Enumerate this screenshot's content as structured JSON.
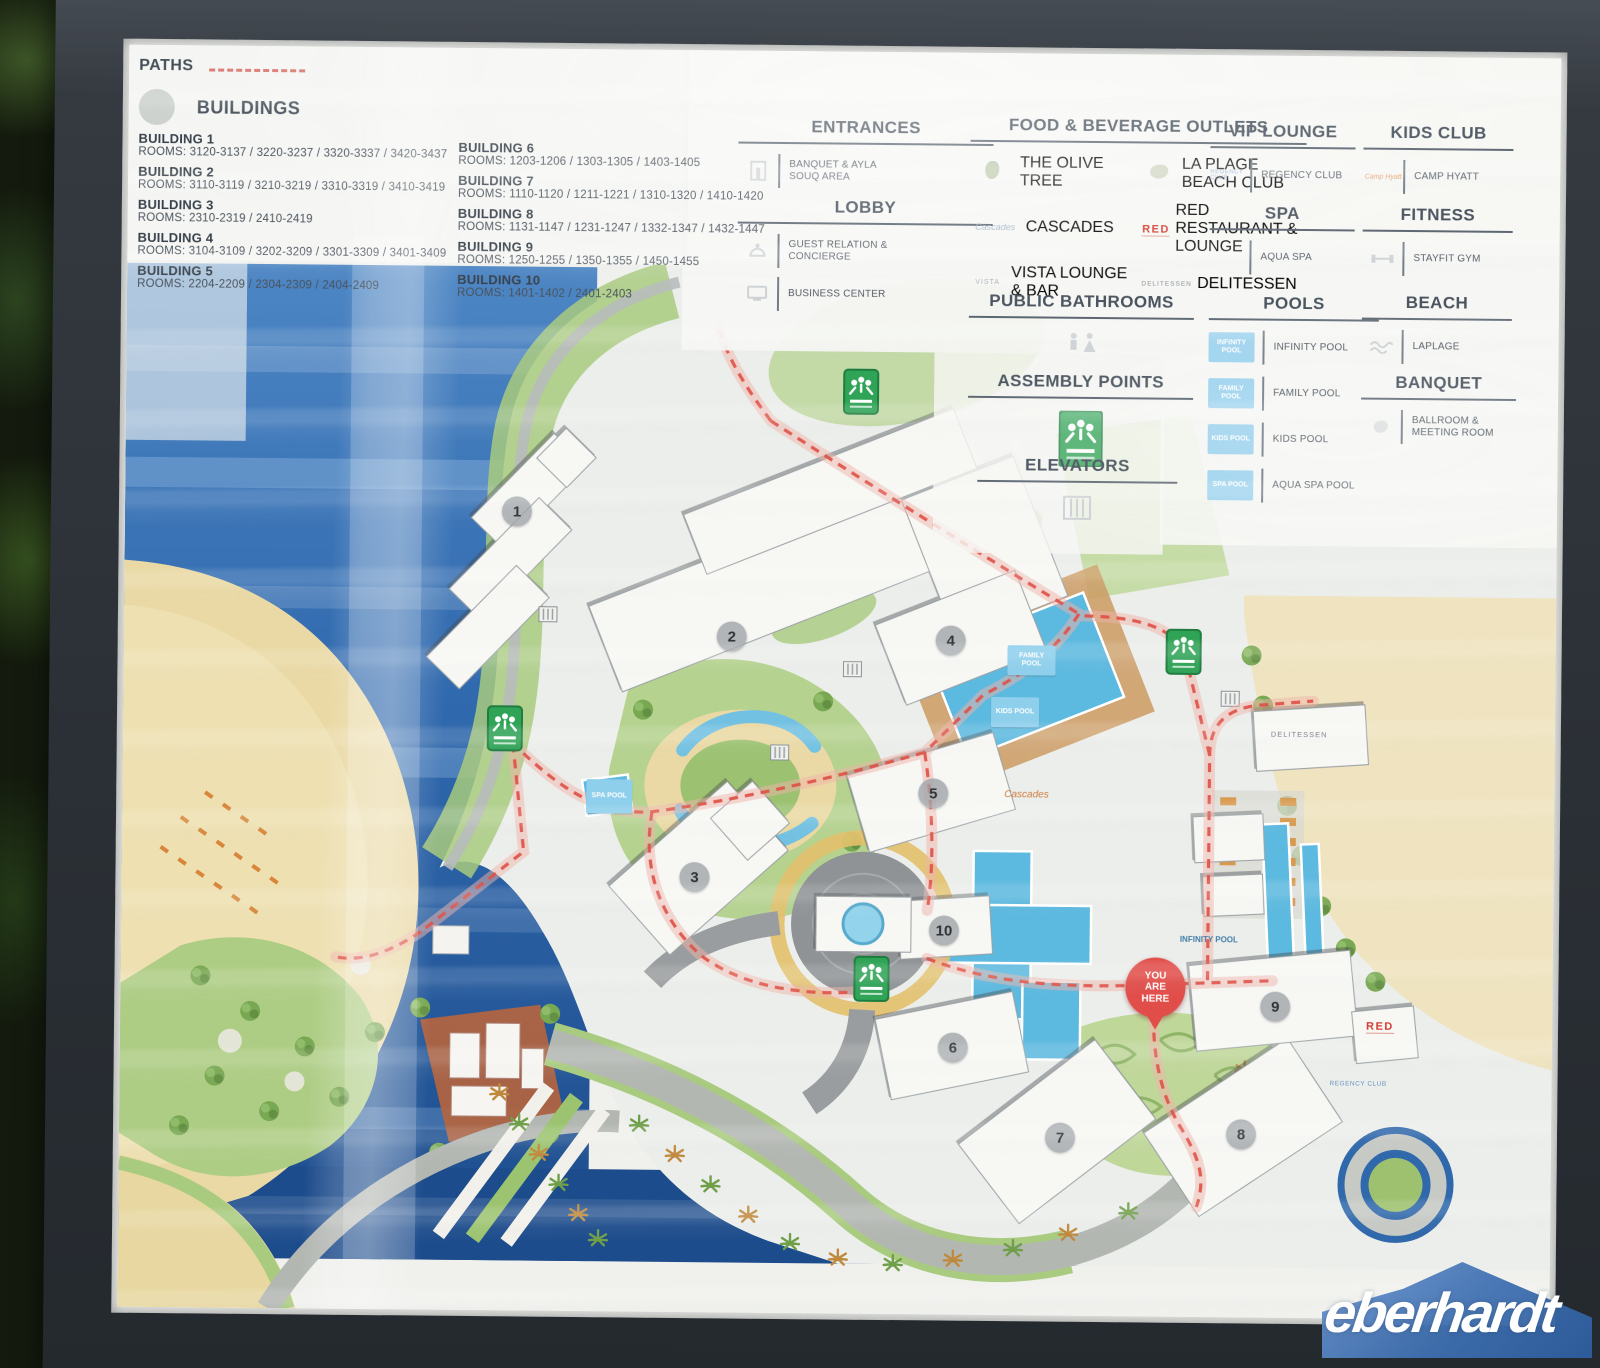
{
  "legend": {
    "paths_label": "PATHS",
    "buildings_label": "BUILDINGS",
    "buildings": [
      {
        "name": "BUILDING 1",
        "rooms": "ROOMS: 3120-3137 / 3220-3237 / 3320-3337 / 3420-3437"
      },
      {
        "name": "BUILDING 2",
        "rooms": "ROOMS: 3110-3119 / 3210-3219 / 3310-3319 / 3410-3419"
      },
      {
        "name": "BUILDING 3",
        "rooms": "ROOMS: 2310-2319 / 2410-2419"
      },
      {
        "name": "BUILDING 4",
        "rooms": "ROOMS: 3104-3109 / 3202-3209 / 3301-3309 / 3401-3409"
      },
      {
        "name": "BUILDING 5",
        "rooms": "ROOMS: 2204-2209 / 2304-2309 / 2404-2409"
      },
      {
        "name": "BUILDING 6",
        "rooms": "ROOMS: 1203-1206 / 1303-1305 / 1403-1405"
      },
      {
        "name": "BUILDING 7",
        "rooms": "ROOMS: 1110-1120 / 1211-1221 / 1310-1320 / 1410-1420"
      },
      {
        "name": "BUILDING 8",
        "rooms": "ROOMS: 1131-1147 / 1231-1247 / 1332-1347 / 1432-1447"
      },
      {
        "name": "BUILDING 9",
        "rooms": "ROOMS: 1250-1255 / 1350-1355 / 1450-1455"
      },
      {
        "name": "BUILDING 10",
        "rooms": "ROOMS: 1401-1402 / 2401-2403"
      }
    ],
    "sections": {
      "entrances": {
        "title": "ENTRANCES",
        "item1": "BANQUET & AYLA SOUQ AREA"
      },
      "lobby": {
        "title": "LOBBY",
        "item1": "GUEST RELATION & CONCIERGE",
        "item2": "BUSINESS CENTER"
      },
      "fnb": {
        "title": "FOOD & BEVERAGE OUTLETS",
        "item1": "THE OLIVE TREE",
        "item2": "LA PLAGE BEACH CLUB",
        "item3": "CASCADES",
        "item4": "RED RESTAURANT & LOUNGE",
        "item5": "VISTA LOUNGE & BAR",
        "item6": "DELITESSEN",
        "logo_red": "RED",
        "logo_delitessen": "DELITESSEN",
        "logo_vista": "VISTA",
        "logo_cascades": "Cascades"
      },
      "vip": {
        "title": "VIP LOUNGE",
        "item1": "REGENCY CLUB",
        "logo": "REGENCY CLUB"
      },
      "kids": {
        "title": "KIDS CLUB",
        "item1": "CAMP HYATT",
        "logo": "Camp Hyatt"
      },
      "spa": {
        "title": "SPA",
        "item1": "AQUA SPA"
      },
      "fitness": {
        "title": "FITNESS",
        "item1": "STAYFIT GYM"
      },
      "bathrooms": {
        "title": "PUBLIC BATHROOMS"
      },
      "assembly": {
        "title": "ASSEMBLY POINTS"
      },
      "elevators": {
        "title": "ELEVATORS"
      },
      "pools": {
        "title": "POOLS",
        "item1": "INFINITY POOL",
        "chip1": "INFINITY POOL",
        "item2": "FAMILY POOL",
        "chip2": "FAMILY POOL",
        "item3": "KIDS POOL",
        "chip3": "KIDS POOL",
        "item4": "AQUA SPA POOL",
        "chip4": "SPA POOL"
      },
      "beach": {
        "title": "BEACH",
        "item1": "LAPLAGE"
      },
      "banquet": {
        "title": "BANQUET",
        "item1": "BALLROOM & MEETING ROOM"
      }
    }
  },
  "map": {
    "markers": [
      "1",
      "2",
      "3",
      "4",
      "5",
      "6",
      "7",
      "8",
      "9",
      "10"
    ],
    "you_are_here": "YOU ARE HERE",
    "labels": {
      "spa_pool": "SPA POOL",
      "family_pool": "FAMILY POOL",
      "kids_pool": "KIDS POOL",
      "infinity_pool": "INFINITY POOL",
      "delitessen": "DELITESSEN",
      "red": "RED",
      "regency_club": "REGENCY CLUB",
      "cascades": "Cascades"
    }
  },
  "watermark": "eberhardt",
  "colors": {
    "accent_red": "#d84b42",
    "sea": "#2a62a8",
    "sand": "#ead9a4",
    "green": "#a8ca7e",
    "assembly_green": "#2fa356",
    "pool_blue": "#5cb9df",
    "pin_red": "#e14e4a",
    "watermark_blue": "#3e6fb0",
    "frame": "#2c3136"
  }
}
